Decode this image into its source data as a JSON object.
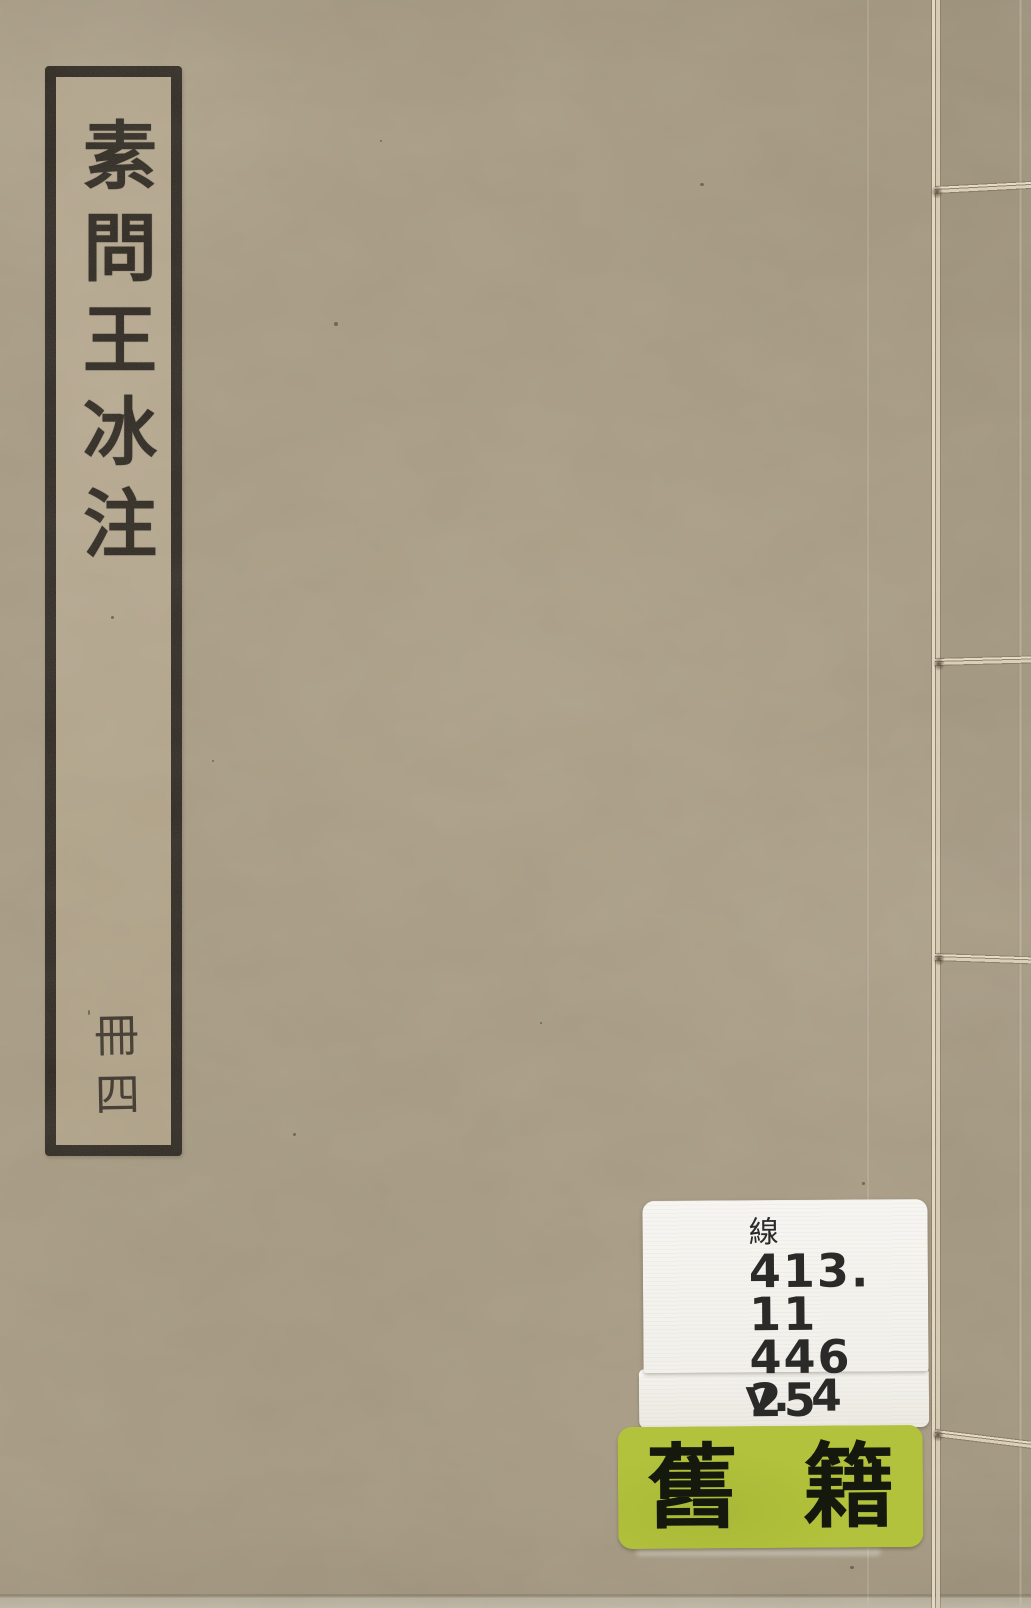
{
  "cover": {
    "background_color": "#a79b84",
    "title_label": {
      "title": "素問王冰注",
      "volume": "冊四",
      "border_color": "#2b2620",
      "paper_color": "#b0a289",
      "text_color": "#2a251f"
    },
    "call_number_sticker": {
      "category_char": "線",
      "call_number_lines": [
        "413. 11",
        "446",
        "25"
      ],
      "volume_line": "v. 4",
      "background_color": "#f5f3ee",
      "text_color": "#2a2a28"
    },
    "category_label": {
      "left_char": "舊",
      "right_char": "籍",
      "background_color": "#b3c23c",
      "text_color": "#15180d"
    },
    "binding": {
      "thread_color": "#ddd3bd"
    }
  }
}
